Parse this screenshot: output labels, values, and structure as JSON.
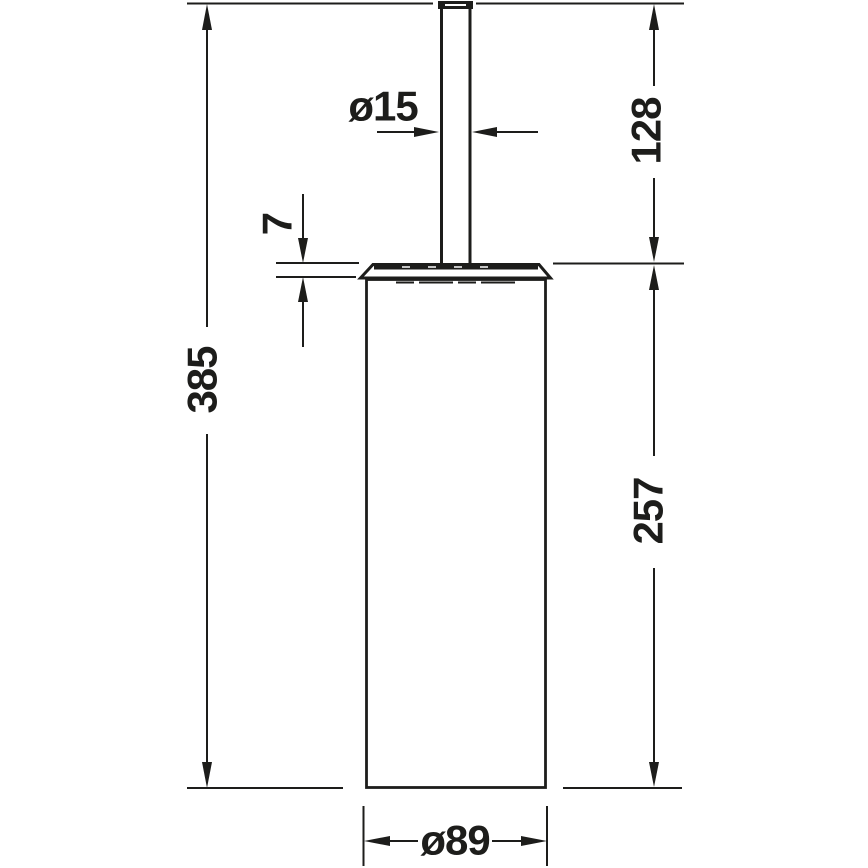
{
  "drawing": {
    "kind": "technical-dimension-drawing",
    "subject": "cylindrical brush holder with handle, front elevation",
    "background_color": "#ffffff",
    "line_color": "#1d1d1b",
    "dimensions": {
      "overall_height": "385",
      "handle_length": "128",
      "lid_thickness": "7",
      "handle_diameter": "ø15",
      "container_height": "257",
      "container_diameter": "ø89"
    }
  }
}
